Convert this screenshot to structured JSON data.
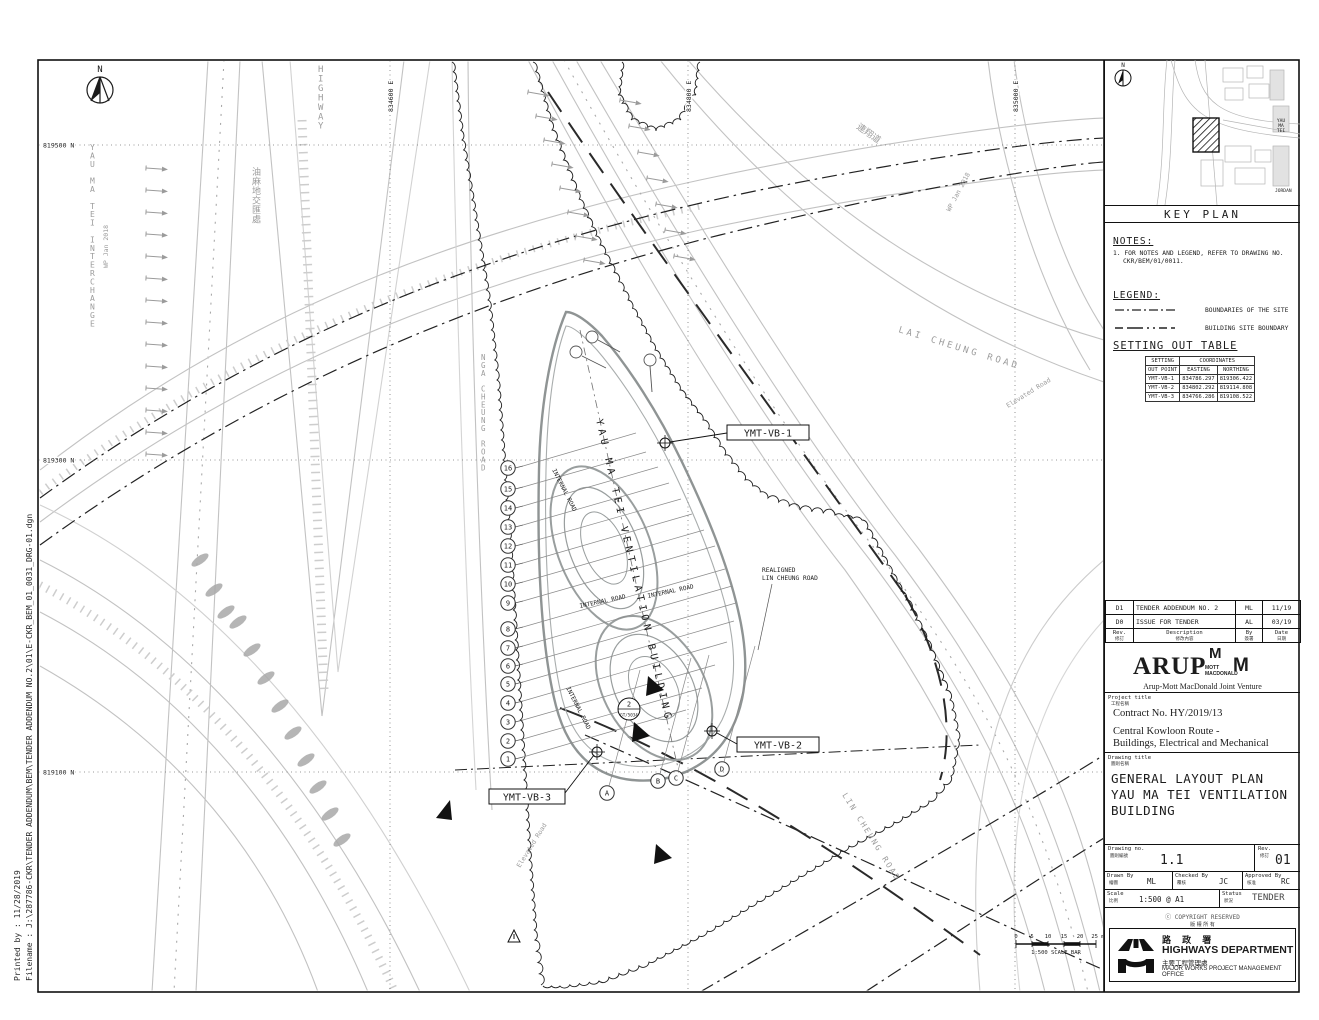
{
  "frame": {
    "printed_by": "Printed by : 11/28/2019",
    "filename": "Filename : J:\\287786-CKR\\TENDER ADDENDUM\\BEM\\TENDER ADDENDUM NO.2\\01\\E-CKR_BEM_01_0031_DRG-01.dgn"
  },
  "plan": {
    "north_label": "N",
    "grid": {
      "northings": [
        "819500 N",
        "819300 N",
        "819100 N"
      ],
      "eastings": [
        "834600 E",
        "834800 E",
        "835000 E"
      ]
    },
    "labels": {
      "building_axis": "YAU MA TEI VENTILATION BUILDING",
      "internal_road": "INTERNAL ROAD",
      "realigned_1": "REALIGNED",
      "realigned_2": "LIN CHEUNG ROAD",
      "nga_cheung": "NGA CHEUNG ROAD",
      "lai_cheung": "LAI CHEUNG ROAD",
      "lin_cheung": "LIN CHEUNG ROAD",
      "highway": "HIGHWAY",
      "interchange": "YAU MA TEI INTERCHANGE",
      "interchange_zh": "油麻地交匯處",
      "lin_cheung_zh": "連翔道",
      "wp": "WP Jan 2018",
      "elevated_road": "Elevated Road"
    },
    "markers": {
      "vb1": "YMT-VB-1",
      "vb2": "YMT-VB-2",
      "vb3": "YMT-VB-3",
      "section_top": "2",
      "section_bottom": "GT/5034"
    },
    "grid_bubbles_numbers": [
      "16",
      "15",
      "14",
      "13",
      "12",
      "11",
      "10",
      "9",
      "8",
      "7",
      "6",
      "5",
      "4",
      "3",
      "2",
      "1"
    ],
    "grid_bubbles_letters": [
      "A",
      "B",
      "C",
      "D"
    ],
    "scalebar": {
      "ticks": [
        "0",
        "5",
        "10",
        "15",
        "20",
        "25 m"
      ],
      "caption": "1:500  SCALE BAR"
    }
  },
  "titleblock": {
    "keyplan": {
      "caption": "KEY PLAN",
      "label_yaumatei": "YAU MA TEI",
      "label_jordan": "JORDAN",
      "north": "N"
    },
    "notes": {
      "heading": "NOTES:",
      "line1": "1.  FOR NOTES AND LEGEND, REFER TO DRAWING NO.",
      "line2": "CKR/BEM/01/0011."
    },
    "legend": {
      "heading": "LEGEND:",
      "item1": "BOUNDARIES OF THE SITE",
      "item2": "BUILDING SITE BOUNDARY"
    },
    "setting_out": {
      "heading": "SETTING OUT TABLE",
      "col_point_1": "SETTING",
      "col_point_2": "OUT POINT",
      "col_coords": "COORDINATES",
      "col_easting": "EASTING",
      "col_northing": "NORTHING",
      "rows": [
        {
          "point": "YMT-VB-1",
          "easting": "834786.297",
          "northing": "819306.422"
        },
        {
          "point": "YMT-VB-2",
          "easting": "834802.292",
          "northing": "819114.808"
        },
        {
          "point": "YMT-VB-3",
          "easting": "834766.286",
          "northing": "819108.522"
        }
      ]
    },
    "revisions": {
      "rows": [
        {
          "rev": "D1",
          "description": "TENDER ADDENDUM NO. 2",
          "by": "ML",
          "date": "11/19"
        },
        {
          "rev": "D0",
          "description": "ISSUE FOR TENDER",
          "by": "AL",
          "date": "03/19"
        }
      ],
      "headers": {
        "rev": "Rev.",
        "rev_zh": "修訂",
        "description": "Description",
        "description_zh": "修改內容",
        "by": "By",
        "by_zh": "簽署",
        "date": "Date",
        "date_zh": "日期"
      }
    },
    "consultant": {
      "arup": "ARUP",
      "mott_m1": "M",
      "mott_m2": "M",
      "mott_line1": "MOTT",
      "mott_line2": "MACDONALD",
      "jv": "Arup-Mott MacDonald Joint Venture"
    },
    "project": {
      "header": "Project title",
      "header_zh": "工程名稱",
      "line1": "Contract No. HY/2019/13",
      "line2": "Central Kowloon Route -",
      "line3": "Buildings, Electrical and Mechanical"
    },
    "drawing_title": {
      "header": "Drawing title",
      "header_zh": "圖則名稱",
      "line1": "GENERAL LAYOUT PLAN",
      "line2": "YAU MA TEI VENTILATION",
      "line3": "BUILDING"
    },
    "numbers": {
      "drawing_no_label": "Drawing no.",
      "drawing_no_zh": "圖則編號",
      "drawing_no": "1.1",
      "rev_label": "Rev.",
      "rev_zh": "修訂",
      "rev": "01"
    },
    "signoff": {
      "drawn_label": "Drawn By",
      "drawn_zh": "繪圖",
      "drawn": "ML",
      "checked_label": "Checked By",
      "checked_zh": "覆核",
      "checked": "JC",
      "approved_label": "Approved By",
      "approved_zh": "核准",
      "approved": "RC"
    },
    "scale_status": {
      "scale_label": "Scale",
      "scale_zh": "比例",
      "scale": "1:500 @ A1",
      "status_label": "Status",
      "status_zh": "狀況",
      "status": "TENDER"
    },
    "copyright": "COPYRIGHT RESERVED",
    "copyright_zh": "版 權 所 有",
    "department": {
      "zh": "路 政 署",
      "en": "HIGHWAYS  DEPARTMENT",
      "office_zh": "主要工程管理處",
      "office_en": "MAJOR WORKS PROJECT MANAGEMENT OFFICE"
    }
  }
}
